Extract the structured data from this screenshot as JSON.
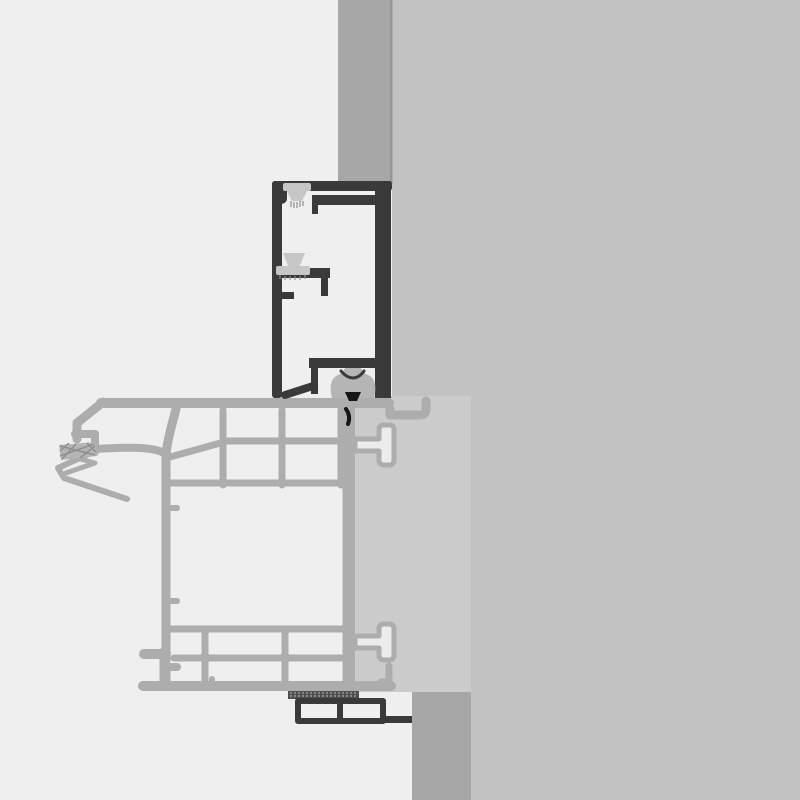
{
  "meta": {
    "type": "technical-cross-section-drawing",
    "domain": "architectural window/door frame detail",
    "visible_text": ""
  },
  "colors": {
    "bg": "#efefef",
    "wall": "#c2c2c2",
    "strip": "#a7a7a7",
    "edge": "#969696",
    "panel": "#cbcbcb",
    "sash": "#adadad",
    "frame": "#3a3a3a",
    "gasket": "#c6c6c6",
    "gasket2": "#b5b5b5",
    "hatch": "#8f8f8f",
    "ink": "#161616",
    "tlight": "#ececec",
    "sealstrip": "#4f4f4f",
    "sealdots": "#9c9c9c"
  },
  "components": [
    "wall-section",
    "lintel-strip",
    "sill-strip",
    "infill-panel",
    "frame-profile",
    "sash-profile",
    "brush-seal-top",
    "brush-seal-mid",
    "compression-gasket",
    "interlock-gasket",
    "glazing-clip-top",
    "glazing-clip-bottom",
    "sill-box-profile",
    "seal-strip"
  ]
}
